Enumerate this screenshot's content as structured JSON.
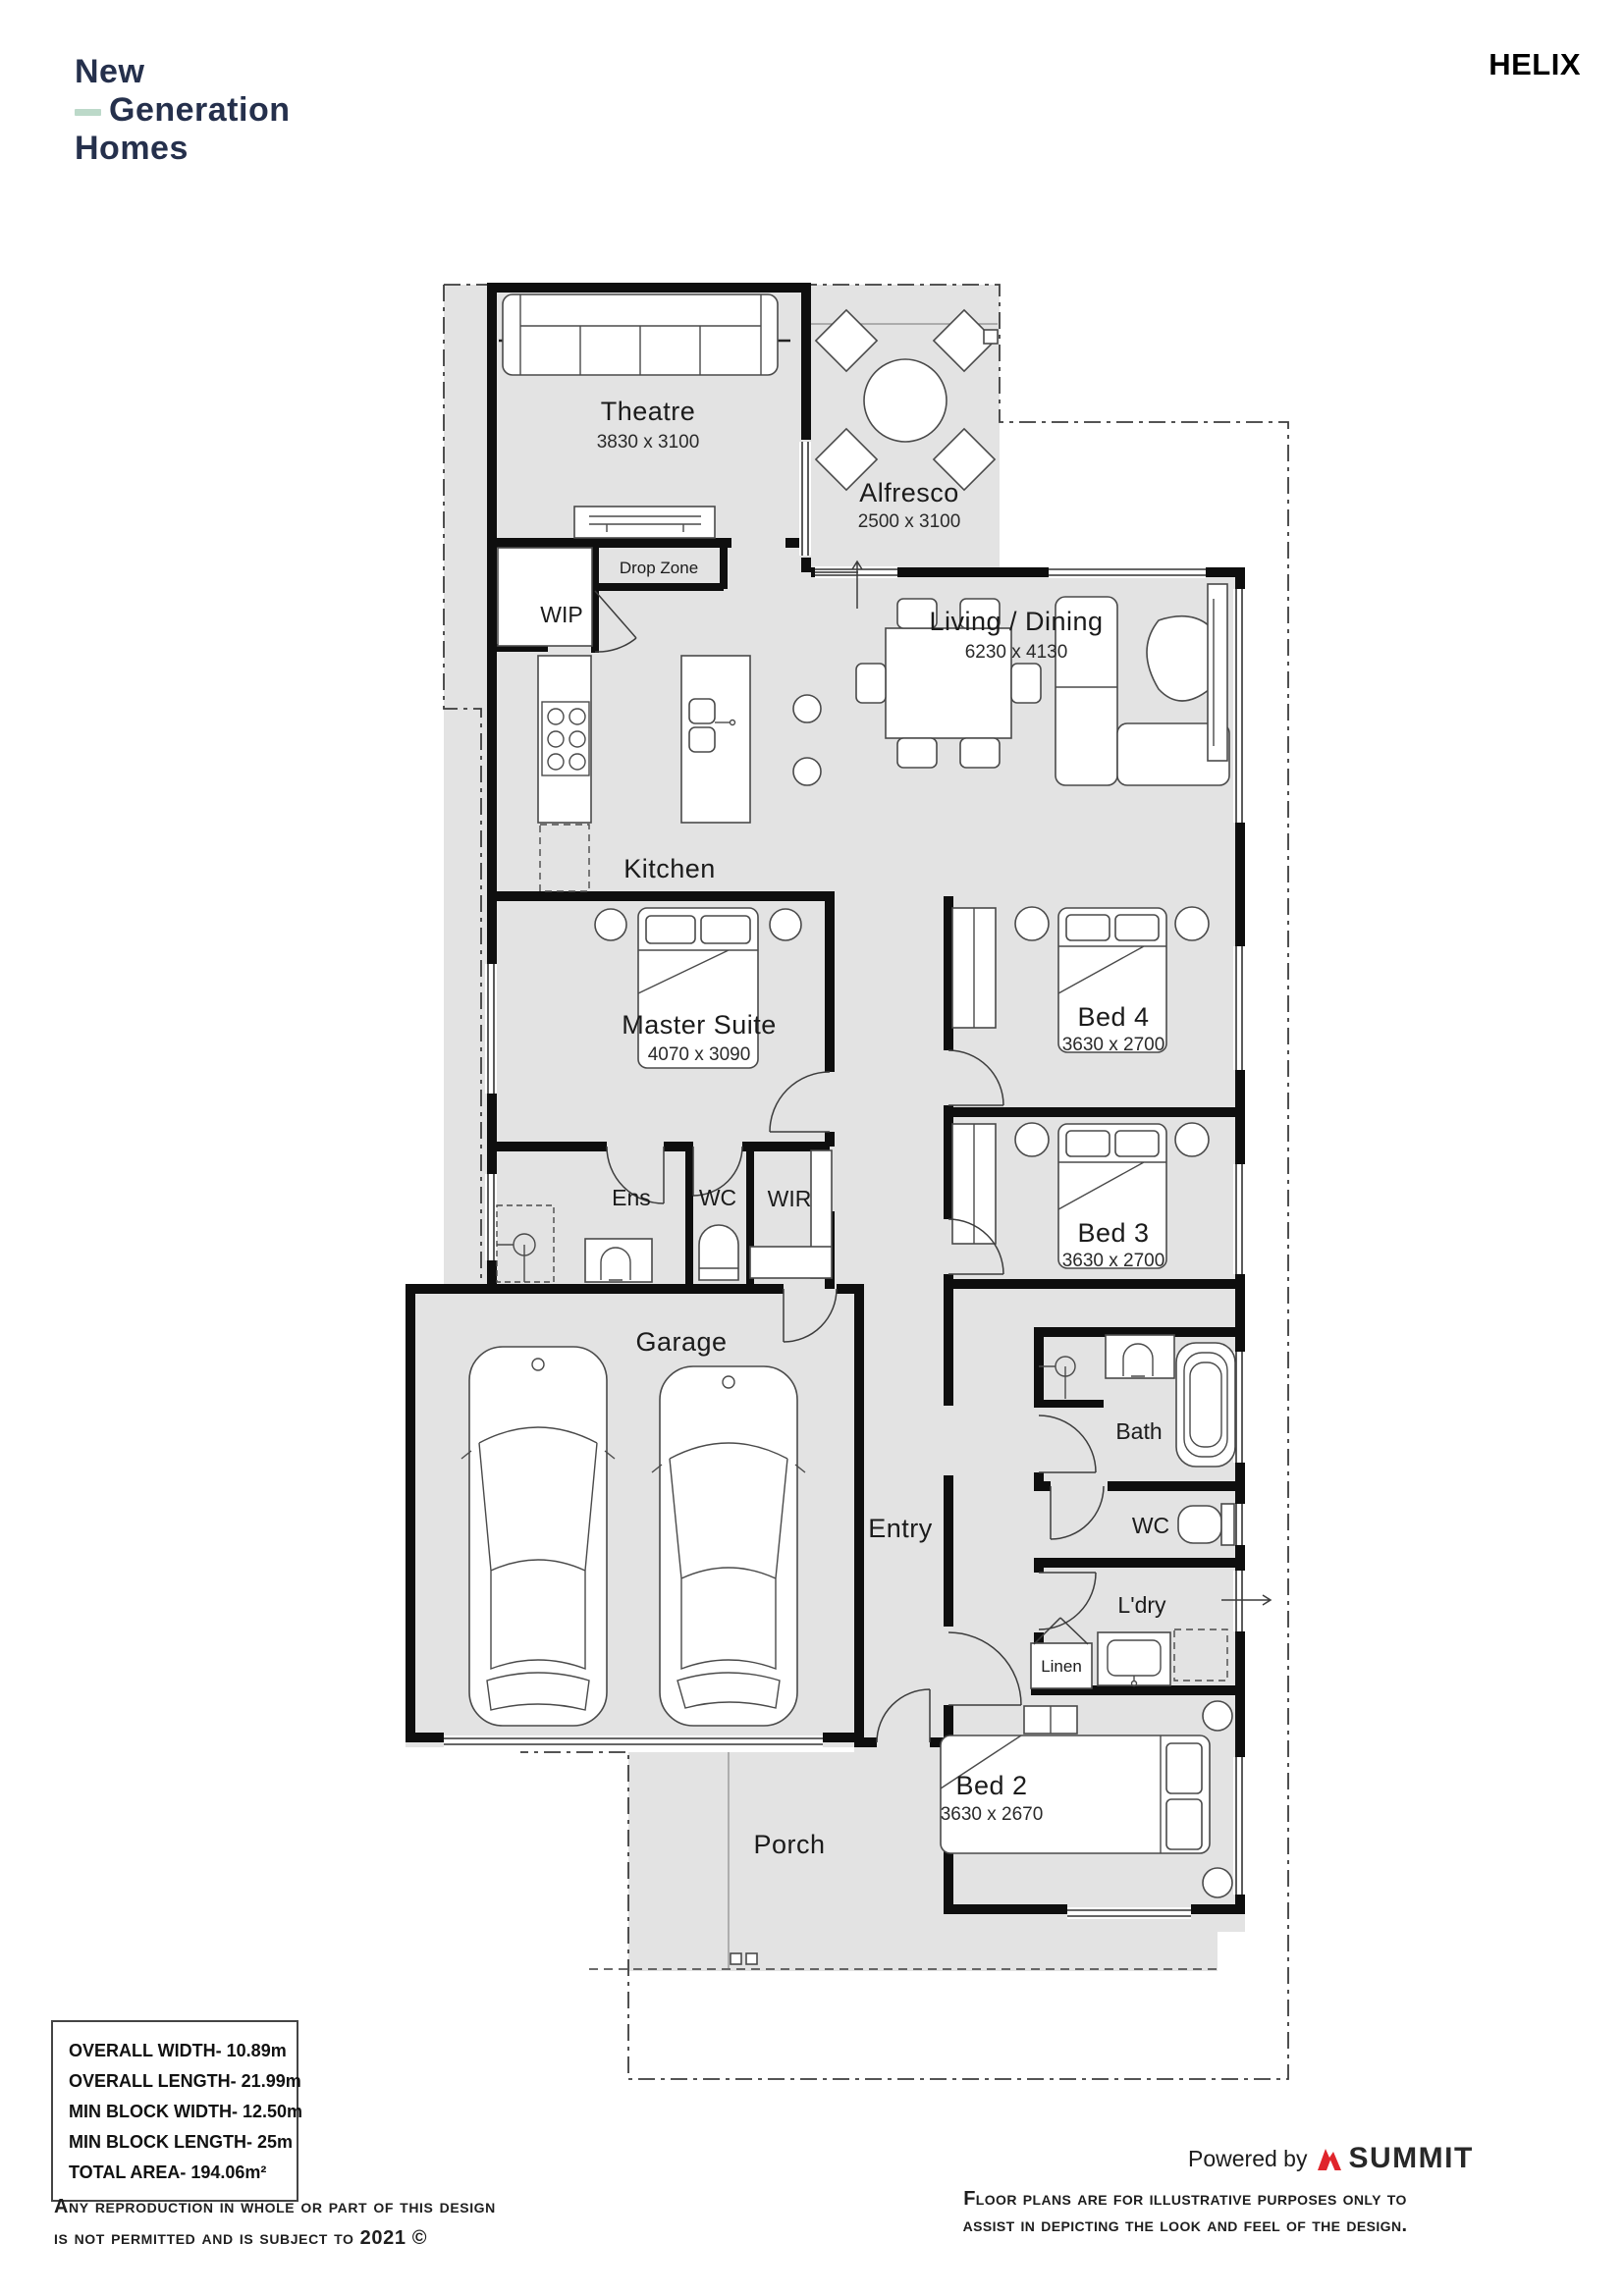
{
  "header": {
    "logo_line1": "New",
    "logo_line2": "Generation",
    "logo_line3": "Homes",
    "plan_name": "HELIX"
  },
  "plan": {
    "rooms": [
      {
        "name": "Theatre",
        "dims": "3830 x 3100"
      },
      {
        "name": "Alfresco",
        "dims": "2500 x 3100"
      },
      {
        "name": "Living / Dining",
        "dims": "6230 x 4130"
      },
      {
        "name": "Kitchen",
        "dims": ""
      },
      {
        "name": "Drop Zone",
        "dims": ""
      },
      {
        "name": "WIP",
        "dims": ""
      },
      {
        "name": "Master Suite",
        "dims": "4070 x 3090"
      },
      {
        "name": "Ens",
        "dims": ""
      },
      {
        "name": "WC",
        "dims": ""
      },
      {
        "name": "WIR",
        "dims": ""
      },
      {
        "name": "Bed 4",
        "dims": "3630 x 2700"
      },
      {
        "name": "Bed 3",
        "dims": "3630 x 2700"
      },
      {
        "name": "Garage",
        "dims": ""
      },
      {
        "name": "Entry",
        "dims": ""
      },
      {
        "name": "Bath",
        "dims": ""
      },
      {
        "name": "WC",
        "dims": ""
      },
      {
        "name": "L'dry",
        "dims": ""
      },
      {
        "name": "Linen",
        "dims": ""
      },
      {
        "name": "Bed 2",
        "dims": "3630 x 2670"
      },
      {
        "name": "Porch",
        "dims": ""
      }
    ]
  },
  "specs": {
    "lines": [
      "OVERALL WIDTH- 10.89m",
      "OVERALL LENGTH- 21.99m",
      "MIN BLOCK WIDTH- 12.50m",
      "MIN BLOCK LENGTH- 25m",
      "TOTAL AREA- 194.06m²"
    ]
  },
  "footer": {
    "copyright_line1": "Any reproduction in whole or part of this design",
    "copyright_line2": "is not permitted and is subject to 2021 ©",
    "powered_by": "Powered by",
    "powered_brand": "SUMMIT",
    "disclaimer_line1": "Floor plans are for illustrative purposes only to",
    "disclaimer_line2": "assist in depicting the look and feel of the design."
  }
}
